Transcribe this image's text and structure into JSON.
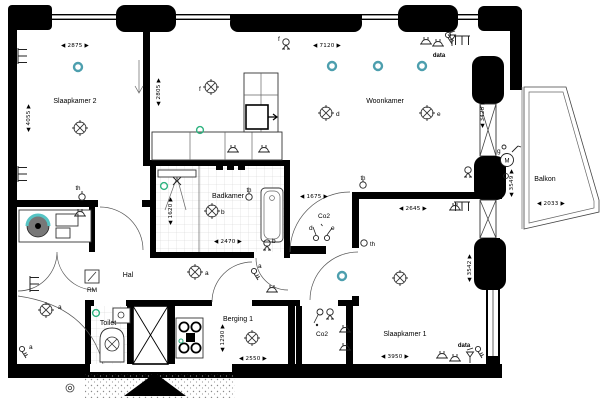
{
  "palette": {
    "wall": "#000000",
    "fixture": "#444444",
    "tile": "#cccccc",
    "teal": "#4d9fae",
    "green": "#2fb380",
    "paper": "#ffffff"
  },
  "rooms": {
    "slaapkamer2": "Slaapkamer 2",
    "woonkamer": "Woonkamer",
    "badkamer": "Badkamer",
    "hal": "Hal",
    "toilet": "Toilet",
    "berging1": "Berging 1",
    "slaapkamer1": "Slaapkamer 1",
    "balkon": "Balkon"
  },
  "annotations": {
    "rm": "RM",
    "data_top": "data",
    "data_bottom": "data",
    "co2_top": "Co2",
    "co2_bottom": "Co2",
    "th_slaapkamer2": "th",
    "th_woonkamer": "th",
    "th_badkamer": "th",
    "th_slaapkamer1": "th",
    "motor": "M"
  },
  "switch_tags": {
    "a1": "a",
    "a2": "a",
    "a3": "a",
    "a4": "a",
    "b1": "b",
    "b2": "b",
    "d1": "d",
    "d2": "d",
    "e1": "e",
    "e2": "e",
    "f1": "f",
    "f2": "f",
    "g1": "g"
  },
  "dimensions_mm": [
    {
      "id": "slaapkamer2-breedte",
      "value": "2875",
      "orientation": "horizontal"
    },
    {
      "id": "slaapkamer2-diepte",
      "value": "4055",
      "orientation": "vertical"
    },
    {
      "id": "keukenwand",
      "value": "2805",
      "orientation": "vertical"
    },
    {
      "id": "woonkamer-breedte",
      "value": "7120",
      "orientation": "horizontal"
    },
    {
      "id": "woonkamer-pui",
      "value": "3428",
      "orientation": "vertical"
    },
    {
      "id": "doorgang-hal",
      "value": "1675",
      "orientation": "horizontal"
    },
    {
      "id": "slaapkamer1-boven",
      "value": "2645",
      "orientation": "horizontal"
    },
    {
      "id": "slaapkamer1-pui",
      "value": "3542",
      "orientation": "vertical"
    },
    {
      "id": "slaapkamer1-breedte",
      "value": "3950",
      "orientation": "horizontal"
    },
    {
      "id": "badkamer-breedte",
      "value": "2470",
      "orientation": "horizontal"
    },
    {
      "id": "douche-diepte",
      "value": "1620",
      "orientation": "vertical"
    },
    {
      "id": "berging-breedte",
      "value": "2550",
      "orientation": "horizontal"
    },
    {
      "id": "berging-diepte",
      "value": "1290",
      "orientation": "vertical"
    },
    {
      "id": "balkon-diepte",
      "value": "3549",
      "orientation": "vertical"
    },
    {
      "id": "balkon-breedte",
      "value": "2033",
      "orientation": "horizontal"
    }
  ]
}
